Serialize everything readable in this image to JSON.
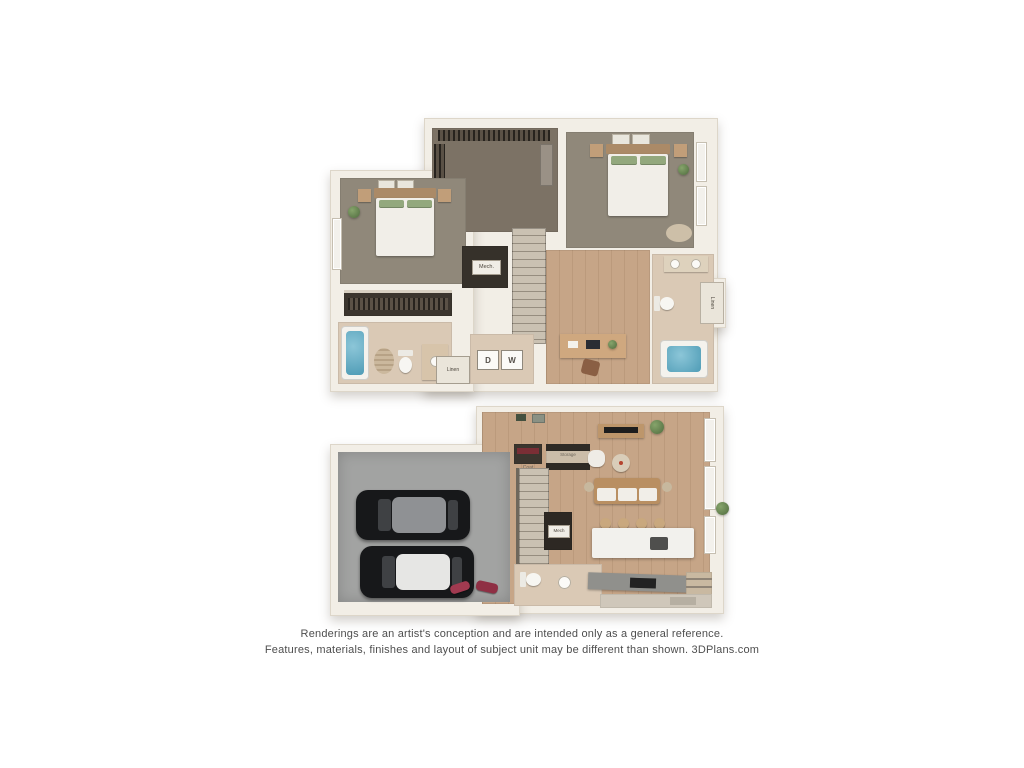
{
  "disclaimer": {
    "line1": "Renderings are an artist's conception and are intended only as a general reference.",
    "line2": "Features, materials, finishes and layout of subject unit may be different than shown. 3DPlans.com"
  },
  "upper_floor": {
    "labels": {
      "mech": "Mech.",
      "linen_closet": "Linen",
      "linen_hall": "Linen",
      "dryer": "D",
      "washer": "W"
    }
  },
  "lower_floor": {
    "labels": {
      "coat": "Coat",
      "storage": "Storage",
      "mech": "Mech",
      "pantry": "Pantry"
    }
  },
  "colors": {
    "wall": "#f2eee6",
    "carpet": "#90887a",
    "wood_floor": "#c6a587",
    "closet_floor": "#7c7265",
    "bath_floor": "#dac9b5",
    "garage_floor": "#a2a3a2",
    "tub_water": "#64aec6",
    "plant_green": "#6b8a57",
    "car_body": "#17181a",
    "text": "#4e4e4e"
  }
}
